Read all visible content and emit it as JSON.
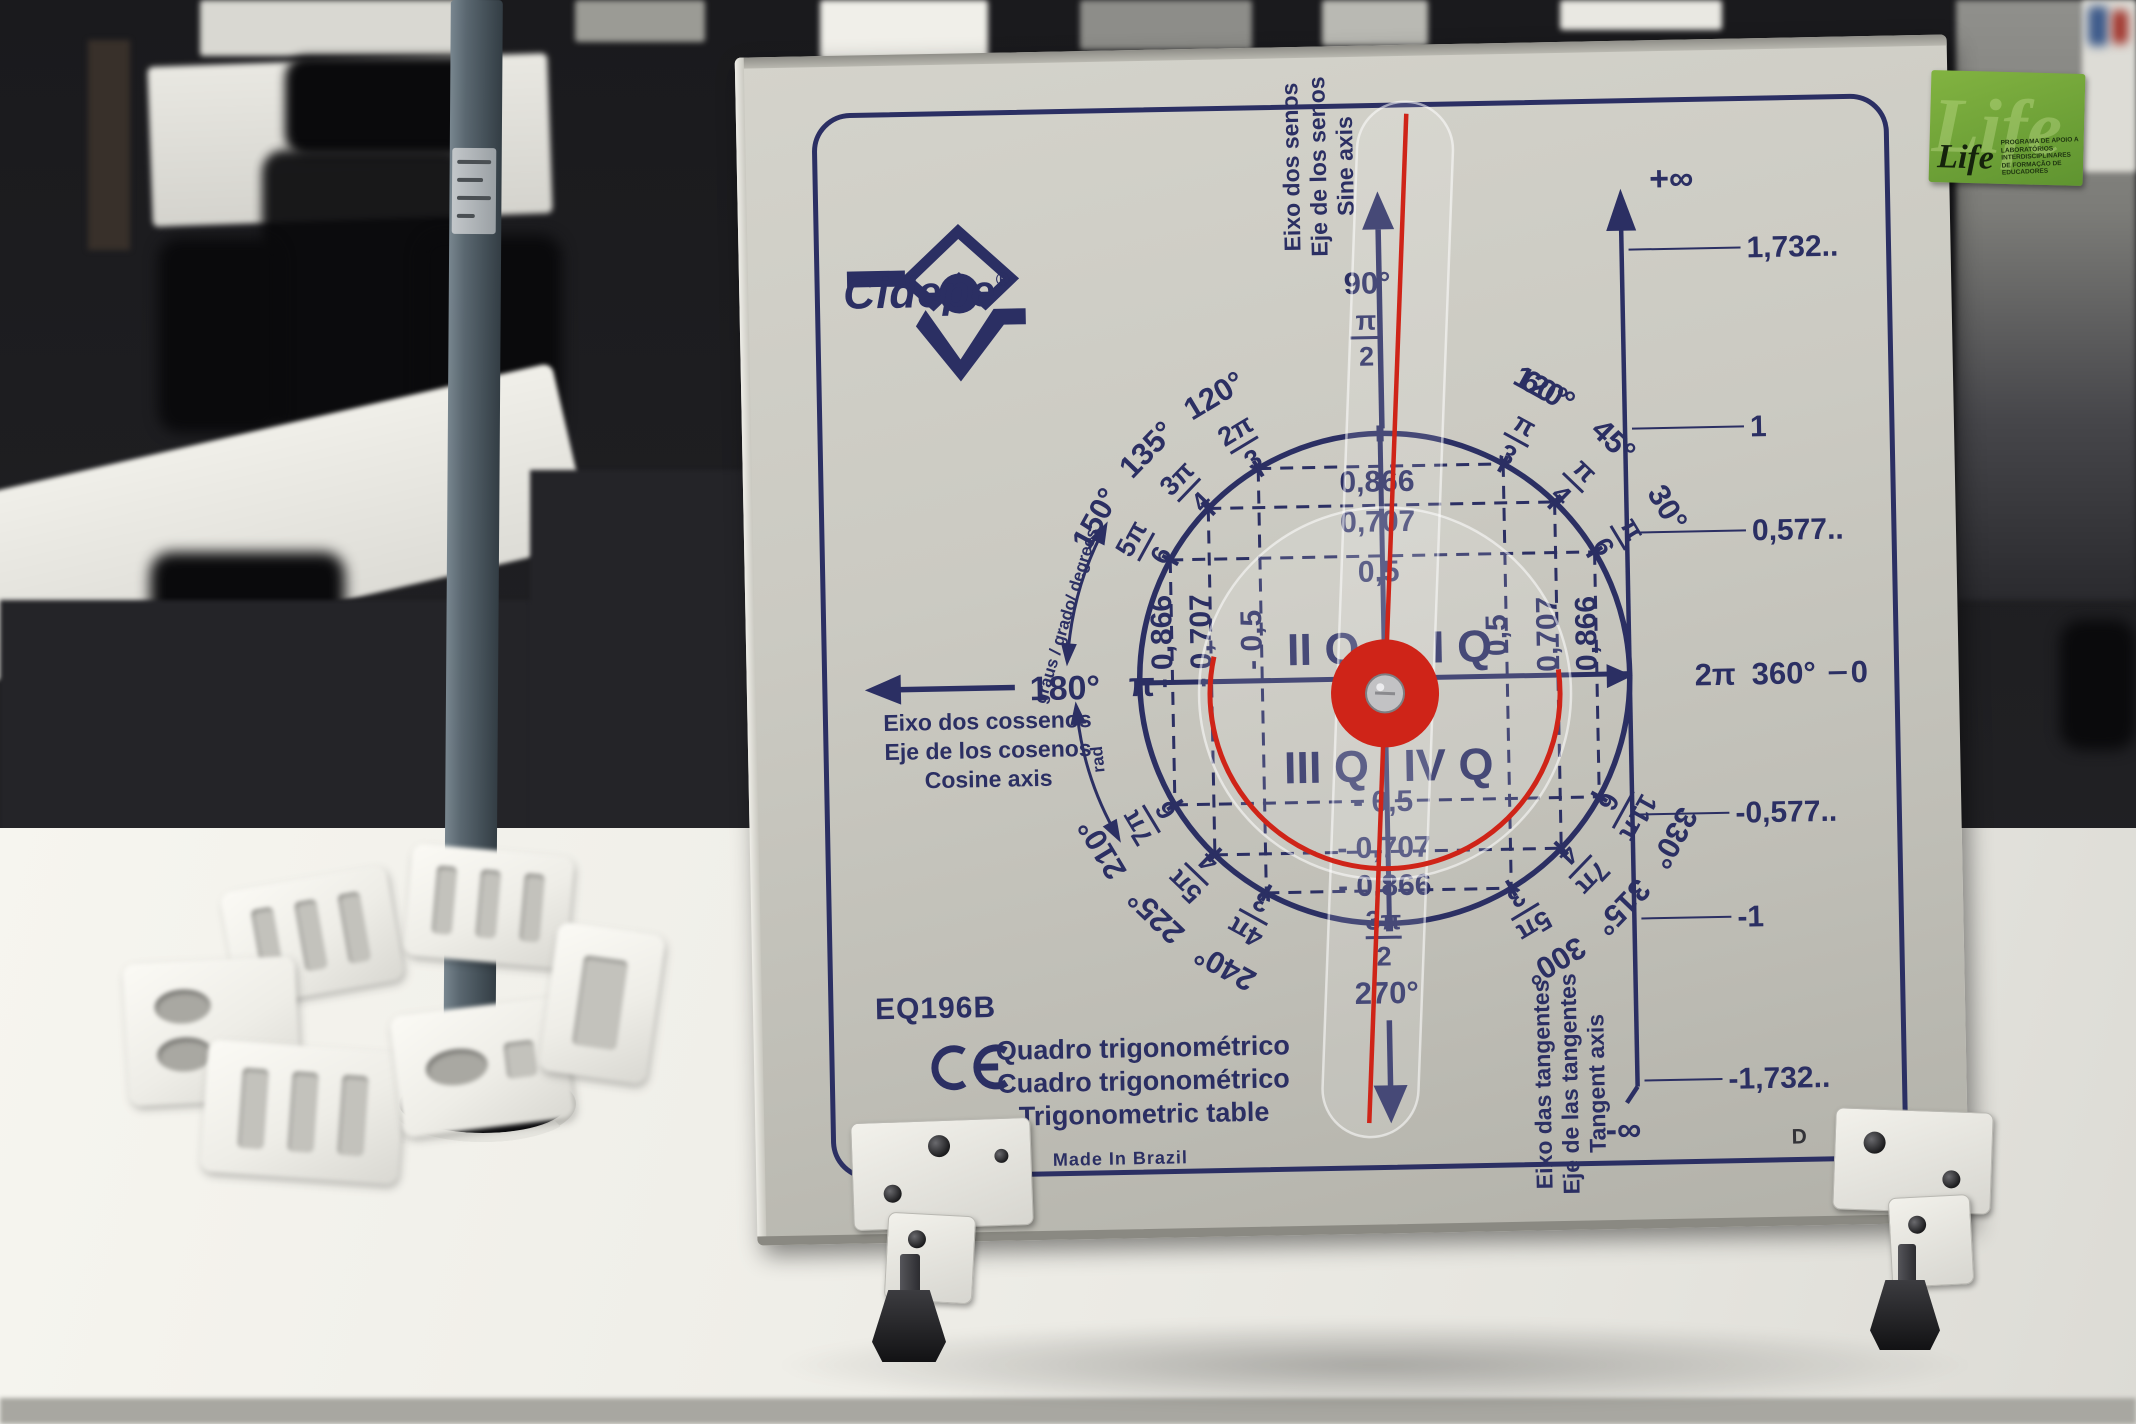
{
  "colors": {
    "board_ink": "#2b2f63",
    "pointer_red": "#cf2418",
    "sticker_green": "#6fa838",
    "board_face": "#c8c7bf"
  },
  "board": {
    "brand": {
      "name": "Cidepe",
      "registered": "®"
    },
    "model": "EQ196B",
    "ce_mark": "CE",
    "title_lines": [
      "Quadro trigonométrico",
      "Cuadro trigonométrico",
      "Trigonometric table"
    ],
    "made_in": "Made In Brazil",
    "corner_letters": {
      "a": "A",
      "b": "B",
      "c": "C",
      "d": "D"
    },
    "axis_labels": {
      "sine": [
        "Eixo dos senos",
        "Eje de los senos",
        "Sine axis"
      ],
      "cosine": [
        "Eixo dos cossenos",
        "Eje de los cosenos",
        "Cosine axis"
      ],
      "tangent": [
        "Eixo das tangentes",
        "Eje de las tangentes",
        "Tangent axis"
      ]
    },
    "arc_labels": {
      "degrees": "graus / grado/ degrees",
      "radians": "rad"
    },
    "quadrants": {
      "q1": "I Q",
      "q2": "II Q",
      "q3": "III Q",
      "q4": "IV Q"
    },
    "sine_values": {
      "positive": [
        "0,866",
        "0,707",
        "0,5"
      ],
      "negative": [
        "- 0,5",
        "- 0,707",
        "- 0,866"
      ]
    },
    "cosine_values": {
      "negative": [
        "- 0,866",
        "- 0,707",
        "- 0,5"
      ],
      "positive": [
        "0,5",
        "0,707",
        "0,866"
      ]
    },
    "tangent_scale": {
      "plus_infinity": "+∞",
      "minus_infinity": "-∞",
      "positive": [
        "1,732..",
        "1",
        "0,577.."
      ],
      "negative": [
        "-0,577..",
        "-1",
        "-1,732.."
      ]
    },
    "angles": [
      {
        "deg": "90°",
        "num": "π",
        "den": "2"
      },
      {
        "deg": "120°",
        "num": "2π",
        "den": "3"
      },
      {
        "deg": "135°",
        "num": "3π",
        "den": "4"
      },
      {
        "deg": "150°",
        "num": "5π",
        "den": "6"
      },
      {
        "deg": "180°",
        "rad": "π"
      },
      {
        "deg": "210°",
        "num": "7π",
        "den": "6"
      },
      {
        "deg": "225°",
        "num": "5π",
        "den": "4"
      },
      {
        "deg": "240°",
        "num": "4π",
        "den": "3"
      },
      {
        "deg": "270°",
        "num": "3π",
        "den": "2"
      },
      {
        "deg": "300°",
        "num": "5π",
        "den": "3"
      },
      {
        "deg": "315°",
        "num": "7π",
        "den": "4"
      },
      {
        "deg": "330°",
        "num": "11π",
        "den": "6"
      },
      {
        "deg": "360°",
        "rad": "2π",
        "zero": "0"
      }
    ]
  },
  "sticker": {
    "brand": "Life",
    "caption": "Programa de apoio a laboratórios interdisciplinares de formação de educadores"
  }
}
